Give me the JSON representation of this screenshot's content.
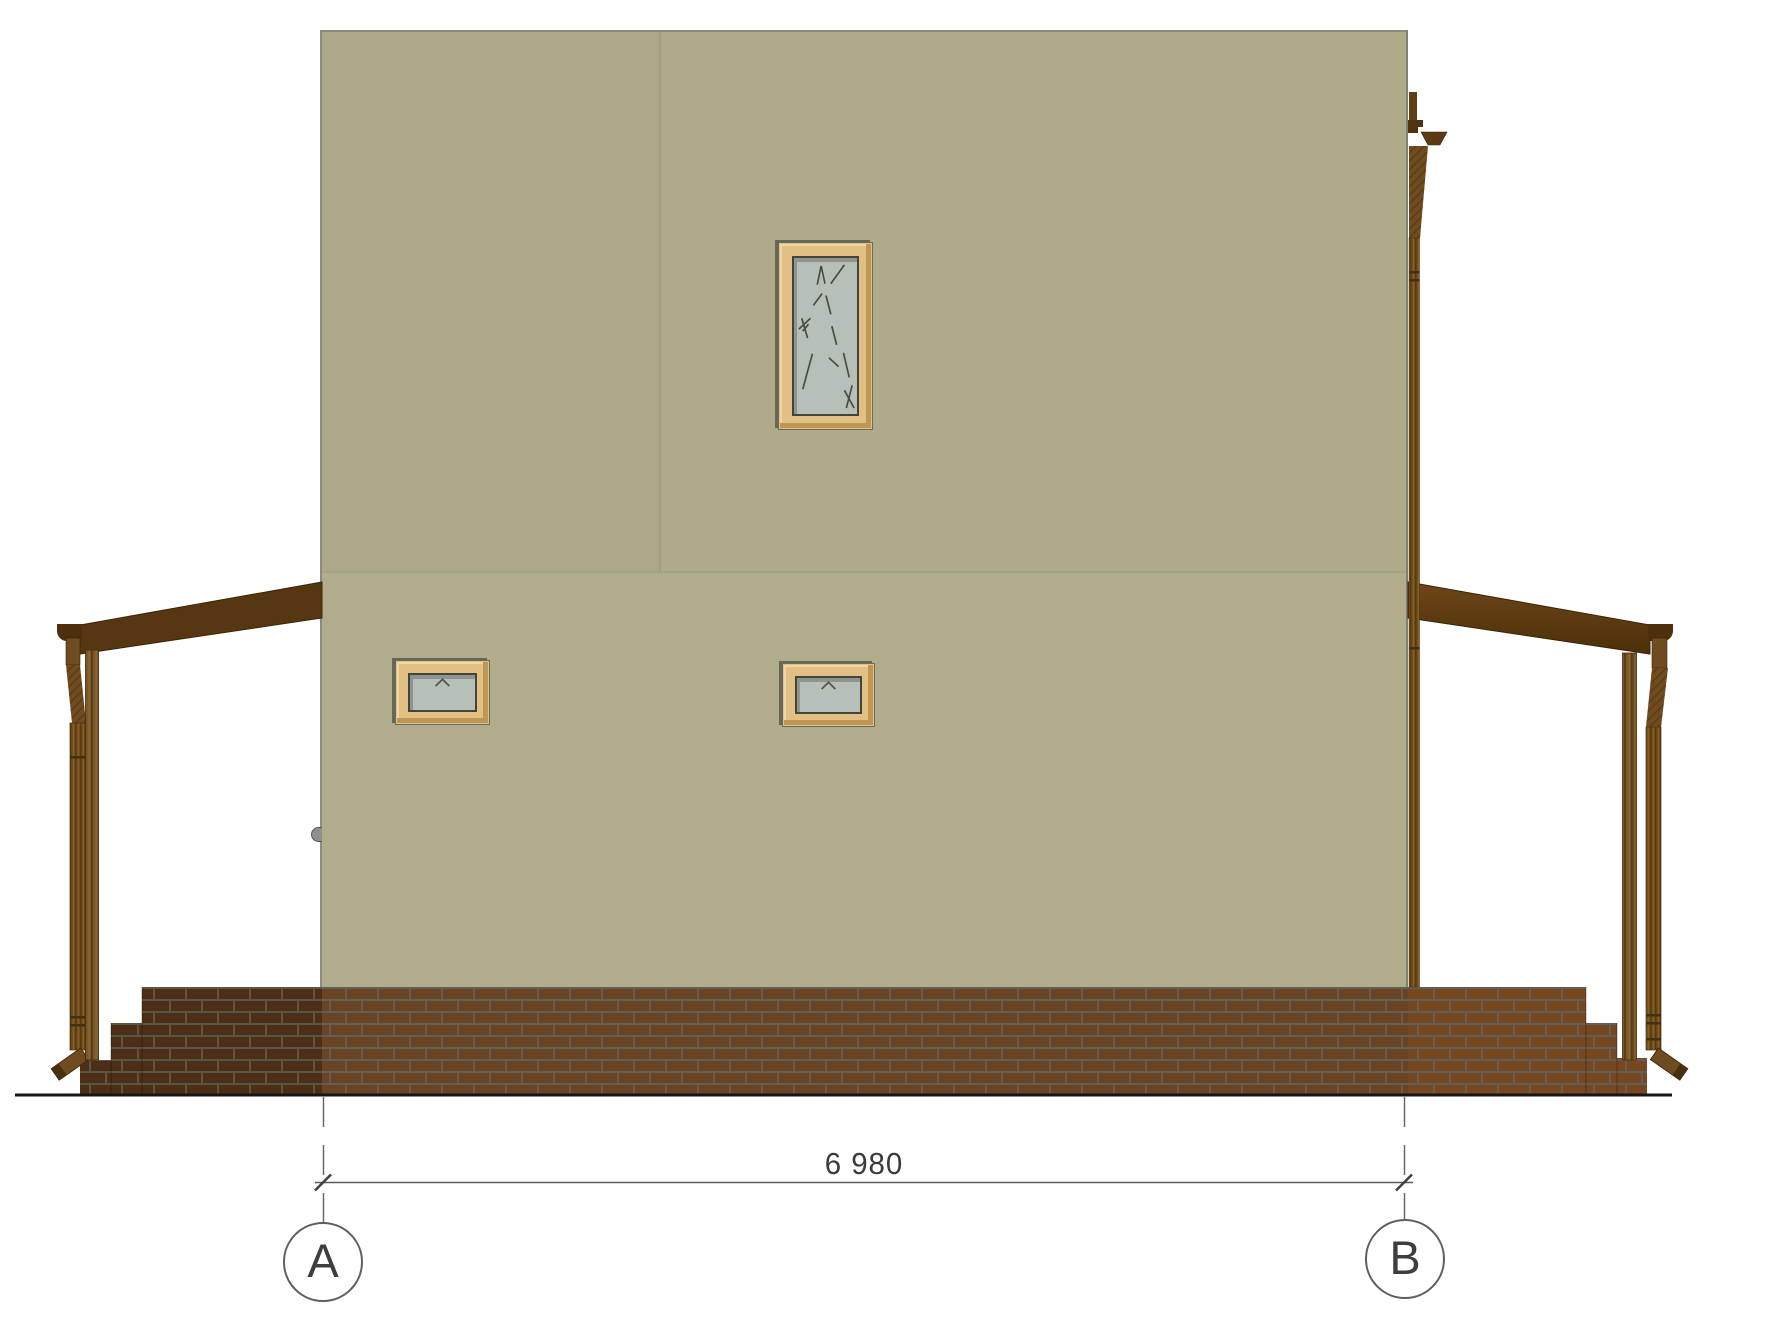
{
  "drawing": {
    "title": "House side elevation (axis A-B)",
    "dimension_label": "6 980",
    "axis_markers": [
      {
        "label": "A"
      },
      {
        "label": "B"
      }
    ],
    "colors": {
      "background": "#FFFFFF",
      "wall": "#B1AD8C",
      "wall_upper_left_panel": "#ABA787",
      "wall_outline": "#8B8B7F",
      "brick_main": "#6B4424",
      "brick_steps_left": "#4C2F16",
      "brick_right": "#77471F",
      "mortar": "#615E55",
      "wood_beam_dark": "#573711",
      "wood_post": "#7A5628",
      "downspout": "#6F4B1F",
      "window_frame": "#E2BF83",
      "window_glass": "#B7BFB9",
      "ground_line": "#161616",
      "annotation_line": "#5E5E5E",
      "annotation_text": "#3B3B3B"
    }
  }
}
